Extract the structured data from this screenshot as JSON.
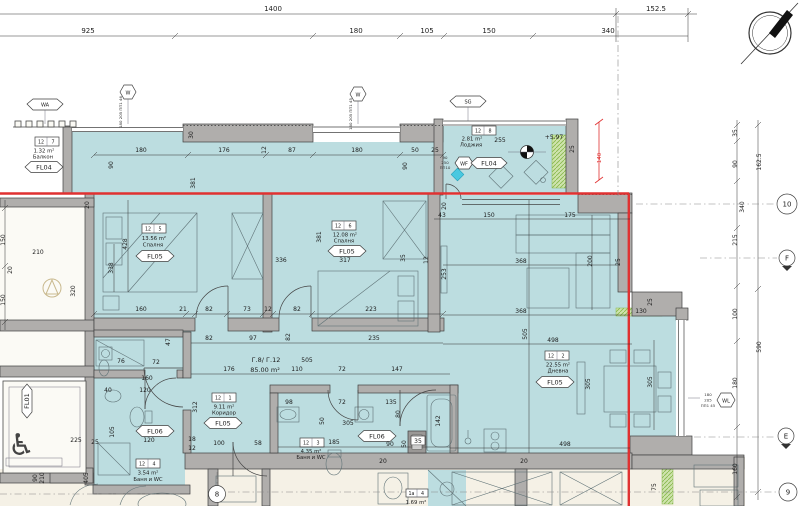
{
  "plan": {
    "header": {
      "row1": {
        "a": "1400",
        "b": "152.5"
      },
      "row2": {
        "a": "925",
        "b": "180",
        "c": "105",
        "d": "150",
        "e": "340"
      }
    },
    "right_col": {
      "d35": "35",
      "d90": "90",
      "d340": "340",
      "d215": "215",
      "d1625": "162.5",
      "d100": "100",
      "d180": "180",
      "d160": "160",
      "d590": "590"
    },
    "left_col": {
      "d150a": "150",
      "d20": "20",
      "d150b": "150",
      "d90": "90",
      "d210": "210",
      "d405": "405"
    },
    "axis": {
      "c10": "10",
      "c9": "9",
      "c8": "8",
      "dE": "E",
      "dF": "F"
    },
    "red": {
      "d140": "140"
    },
    "level": "+5.97",
    "apartment": {
      "code": "Г.8/ Г.12",
      "area": "85.00 m²"
    },
    "rooms": {
      "balkon": {
        "tl": "12",
        "tr": "7",
        "area": "1.32 m²",
        "name": "Балкон",
        "label": "FL04"
      },
      "bed1": {
        "tl": "12",
        "tr": "5",
        "area": "13.56 m²",
        "name": "Спалня",
        "label": "FL05"
      },
      "bed2": {
        "tl": "12",
        "tr": "6",
        "area": "12.08 m²",
        "name": "Спалня",
        "label": "FL05"
      },
      "loggia": {
        "tl": "12",
        "tr": "8",
        "area": "2.81 m²",
        "name": "Лоджия",
        "label": "FL04"
      },
      "living": {
        "tl": "12",
        "tr": "2",
        "area": "22.55 m²",
        "name": "Дневна",
        "label": "FL05"
      },
      "corridor": {
        "tl": "12",
        "tr": "1",
        "area": "9.11 m²",
        "name": "Коридор",
        "label": "FL05"
      },
      "bath1": {
        "tl": "12",
        "tr": "4",
        "area": "3.54 m²",
        "name": "Баня и WC",
        "label": "FL06"
      },
      "bath2": {
        "tl": "12",
        "tr": "3",
        "area": "4.35 m²",
        "name": "Баня и WC",
        "label": "FL06"
      },
      "elevator": {
        "label": "FL01"
      },
      "neighbor": {
        "tl": "1a",
        "tr": "4",
        "area": "1.69 m²"
      }
    },
    "win": {
      "wa": "WA",
      "sg": "SG",
      "w1": "W",
      "w2": "W",
      "wf": "WF",
      "wl": "WL",
      "w1s": "180 205 ПП1 46",
      "w2s": "180 205 ПП1 45",
      "wfs": {
        "a": "90",
        "b": "250",
        "c": "ПП10"
      },
      "wls": {
        "a": "180",
        "b": "205",
        "c": "ПП1 45"
      }
    },
    "dims": {
      "r151": {
        "a": "180",
        "b": "176",
        "c": "12",
        "d": "87",
        "e": "180",
        "f": "50",
        "g": "25"
      },
      "top": {
        "d30": "30",
        "d90": "90",
        "d381": "381",
        "bk90": "90"
      },
      "bed1": {
        "d428": "428",
        "d338": "338",
        "d336": "336"
      },
      "r313": {
        "a": "160",
        "b": "21",
        "c": "82",
        "d": "73",
        "e": "12",
        "f": "82",
        "g": "223"
      },
      "bed2": {
        "d381": "381",
        "d317": "317",
        "d35": "35",
        "d12": "12",
        "d253": "253",
        "d20": "20"
      },
      "log": {
        "d255": "255",
        "d25": "25"
      },
      "liv": {
        "d43": "43",
        "d150": "150",
        "d175": "175",
        "d368a": "368",
        "d200": "200",
        "d25": "25",
        "d368b": "368",
        "d505": "505",
        "d498a": "498",
        "d498b": "498",
        "d305a": "305",
        "d305b": "305",
        "d130": "130",
        "d20a": "20",
        "d20b": "20",
        "d25b": "25",
        "d75": "75"
      },
      "r341": {
        "a": "82",
        "b": "97",
        "c": "82",
        "d": "235"
      },
      "r360": {
        "d505": "505"
      },
      "r372": {
        "a": "176",
        "b": "110",
        "c": "72",
        "d": "147"
      },
      "cor": {
        "d312": "312",
        "d100": "100",
        "d58": "58",
        "d18": "18",
        "d12": "12"
      },
      "nic": {
        "d47": "47",
        "d76": "76",
        "d72": "72",
        "d160": "160",
        "d40": "40",
        "d120a": "120",
        "d105": "105",
        "d120b": "120"
      },
      "bath": {
        "d98": "98",
        "d72": "72",
        "d135": "135",
        "d80": "80",
        "d50a": "50",
        "d305": "305",
        "d185": "185",
        "d50b": "50",
        "d35": "35",
        "d90": "90",
        "d142": "142"
      },
      "nei": {
        "d210": "210",
        "d320": "320",
        "d20": "20"
      },
      "elev": {
        "d225": "225",
        "d25": "25"
      }
    }
  }
}
